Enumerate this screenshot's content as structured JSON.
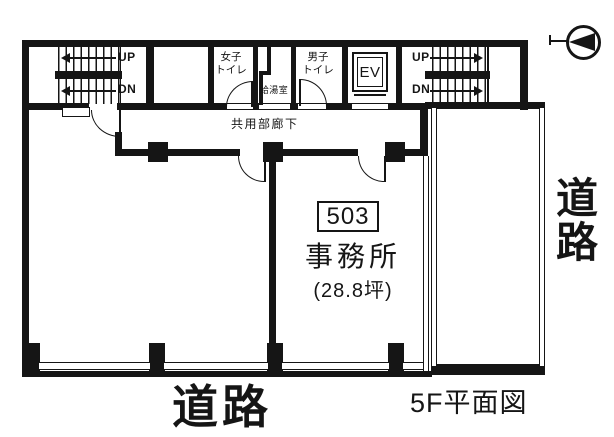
{
  "palette": {
    "ink": "#151515",
    "paper": "#ffffff"
  },
  "caption": "5F平面図",
  "unit": {
    "number": "503",
    "use": "事務所",
    "area": "(28.8坪)"
  },
  "corridor": {
    "label": "共用部廊下"
  },
  "rooms": {
    "women_toilet": {
      "line1": "女子",
      "line2": "トイレ"
    },
    "men_toilet": {
      "line1": "男子",
      "line2": "トイレ"
    },
    "kitchenette": {
      "label": "給湯室"
    },
    "elevator": {
      "label": "EV"
    }
  },
  "stairs": {
    "left": {
      "up": "UP",
      "down": "DN"
    },
    "right": {
      "up": "UP",
      "down": "DN"
    }
  },
  "roads": {
    "bottom": "道路",
    "right": "道路"
  },
  "icons": {
    "compass": "north-arrow"
  }
}
